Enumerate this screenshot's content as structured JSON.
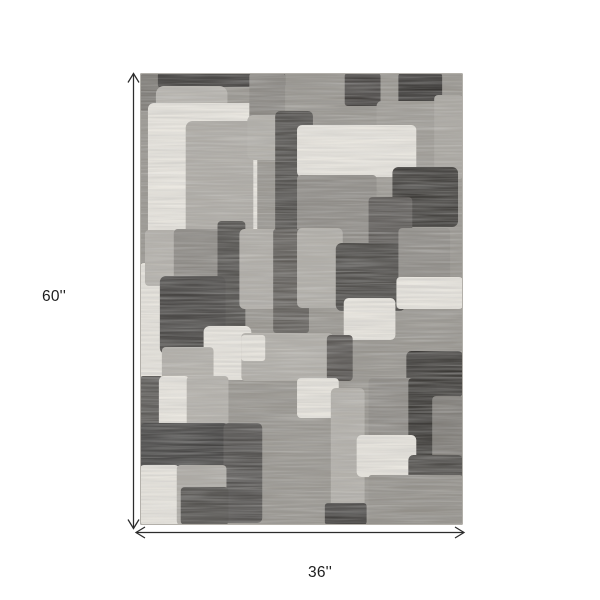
{
  "page": {
    "background": "#ffffff"
  },
  "annotations": {
    "height_label": "60''",
    "width_label": "36''",
    "line_color": "#2c2c2c",
    "text_color": "#1d1d1d"
  },
  "rug": {
    "base_color": "#97948e",
    "border_color": "#b3b0aa",
    "palette": {
      "ivory": "#e9e6df",
      "light_gray": "#b5b2ac",
      "medium_gray": "#8e8b86",
      "dark_gray": "#555350",
      "charcoal": "#3c3a38"
    },
    "shapes": [
      [
        0,
        0,
        24,
        38,
        3,
        "#7b7873"
      ],
      [
        18,
        0,
        128,
        14,
        2,
        "#3b3937"
      ],
      [
        16,
        13,
        72,
        24,
        8,
        "#b6b3ad"
      ],
      [
        8,
        30,
        110,
        134,
        6,
        "#e9e6df"
      ],
      [
        46,
        48,
        68,
        118,
        7,
        "#adaaa4"
      ],
      [
        110,
        0,
        36,
        47,
        3,
        "#8a8782"
      ],
      [
        108,
        42,
        36,
        45,
        6,
        "#b1aea8"
      ],
      [
        136,
        38,
        38,
        132,
        5,
        "#504e4b"
      ],
      [
        206,
        0,
        36,
        33,
        3,
        "#454240"
      ],
      [
        260,
        0,
        44,
        33,
        3,
        "#393735"
      ],
      [
        238,
        28,
        64,
        92,
        5,
        "#9e9b95"
      ],
      [
        296,
        22,
        29,
        84,
        4,
        "#a9a6a0"
      ],
      [
        158,
        52,
        120,
        52,
        5,
        "#e9e6df"
      ],
      [
        254,
        94,
        66,
        60,
        6,
        "#3e3c39"
      ],
      [
        158,
        102,
        80,
        68,
        4,
        "#8e8b86"
      ],
      [
        230,
        124,
        44,
        76,
        4,
        "#5c5956"
      ],
      [
        0,
        190,
        27,
        136,
        4,
        "#e7e4dd"
      ],
      [
        5,
        157,
        32,
        56,
        4,
        "#b3b0aa"
      ],
      [
        34,
        156,
        50,
        56,
        4,
        "#8c8984"
      ],
      [
        78,
        148,
        28,
        112,
        4,
        "#4f4d4a"
      ],
      [
        100,
        156,
        44,
        80,
        5,
        "#afaca6"
      ],
      [
        134,
        156,
        36,
        104,
        3,
        "#615e5a"
      ],
      [
        20,
        203,
        66,
        78,
        6,
        "#484644"
      ],
      [
        64,
        253,
        48,
        54,
        6,
        "#e8e5de"
      ],
      [
        22,
        274,
        52,
        52,
        4,
        "#b2afa9"
      ],
      [
        158,
        155,
        46,
        80,
        5,
        "#b0ada7"
      ],
      [
        197,
        170,
        70,
        68,
        6,
        "#4b4946"
      ],
      [
        260,
        155,
        52,
        58,
        4,
        "#8e8b86"
      ],
      [
        258,
        204,
        67,
        32,
        4,
        "#e8e5de"
      ],
      [
        205,
        225,
        52,
        42,
        5,
        "#e8e5de"
      ],
      [
        102,
        260,
        92,
        48,
        4,
        "#b0ada7"
      ],
      [
        102,
        262,
        24,
        26,
        3,
        "#e7e4dd"
      ],
      [
        188,
        262,
        26,
        46,
        4,
        "#565350"
      ],
      [
        268,
        278,
        57,
        46,
        5,
        "#3d3b38"
      ],
      [
        0,
        303,
        23,
        52,
        3,
        "#595754"
      ],
      [
        19,
        303,
        31,
        92,
        5,
        "#e9e6df"
      ],
      [
        47,
        303,
        42,
        52,
        4,
        "#b3b0aa"
      ],
      [
        0,
        350,
        89,
        46,
        5,
        "#424140"
      ],
      [
        84,
        350,
        39,
        100,
        5,
        "#545250"
      ],
      [
        0,
        392,
        39,
        60,
        4,
        "#e8e5de"
      ],
      [
        37,
        392,
        50,
        60,
        4,
        "#adaaa4"
      ],
      [
        41,
        414,
        48,
        38,
        4,
        "#4e4c49"
      ],
      [
        158,
        305,
        42,
        40,
        4,
        "#e7e4dd"
      ],
      [
        192,
        315,
        34,
        137,
        5,
        "#b2afa9"
      ],
      [
        230,
        305,
        46,
        60,
        4,
        "#8d8a85"
      ],
      [
        270,
        305,
        28,
        80,
        4,
        "#3c3a37"
      ],
      [
        294,
        323,
        31,
        84,
        4,
        "#7f7c77"
      ],
      [
        218,
        362,
        60,
        42,
        5,
        "#e8e5de"
      ],
      [
        270,
        382,
        55,
        48,
        5,
        "#4d4b48"
      ],
      [
        230,
        402,
        95,
        50,
        3,
        "#93908a"
      ],
      [
        186,
        430,
        42,
        22,
        3,
        "#444240"
      ]
    ]
  }
}
